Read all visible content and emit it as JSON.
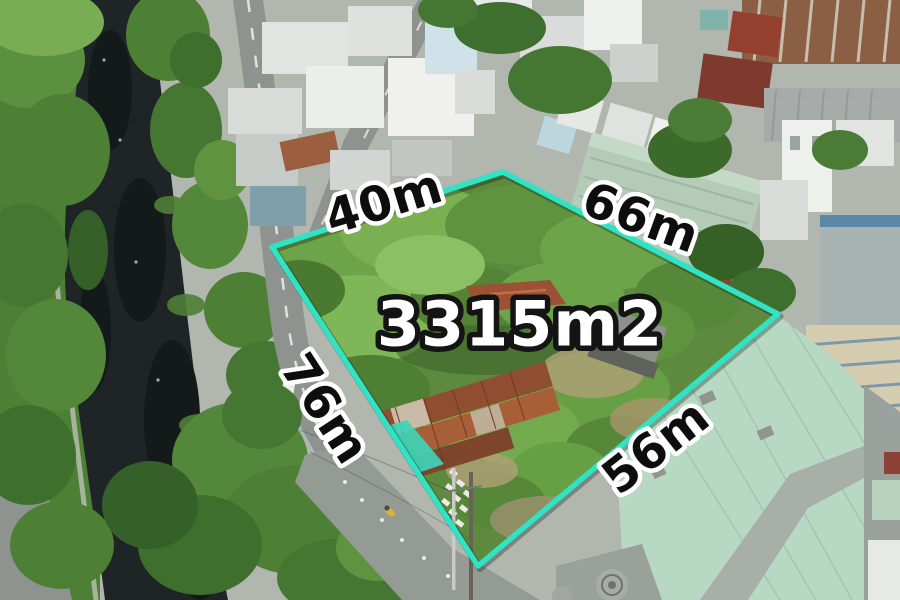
{
  "scene": {
    "type": "aerial-drone-photo",
    "description": "Aerial view of a vacant overgrown land plot outlined in teal, bordered by a dark tree-lined canal and curving road on the left, and dense low-rise houses with rusty corrugated and mint-green metal roofs on the right.",
    "palette": {
      "canal_water": "#1F2426",
      "tree_canopy": "#4D8034",
      "road_asphalt": "#8E9390",
      "urban_base": "#B1B6AF",
      "rusty_roof": "#8A5F44",
      "mint_warehouse_roof": "#B7D8C3",
      "plot_vegetation": "#5D8A3E"
    }
  },
  "annotation": {
    "boundary_color": "#2FE3C4",
    "boundary_width_px": 6,
    "area": {
      "label": "3315m2",
      "text_color": "#FFFFFF",
      "outline_color": "#141414"
    },
    "edges": {
      "top_left": {
        "label": "40m"
      },
      "top_right": {
        "label": "66m"
      },
      "left": {
        "label": "76m"
      },
      "bottom_right": {
        "label": "56m"
      }
    },
    "edge_text_color": "#0D0D0D",
    "edge_outline_color": "#FFFFFF"
  }
}
